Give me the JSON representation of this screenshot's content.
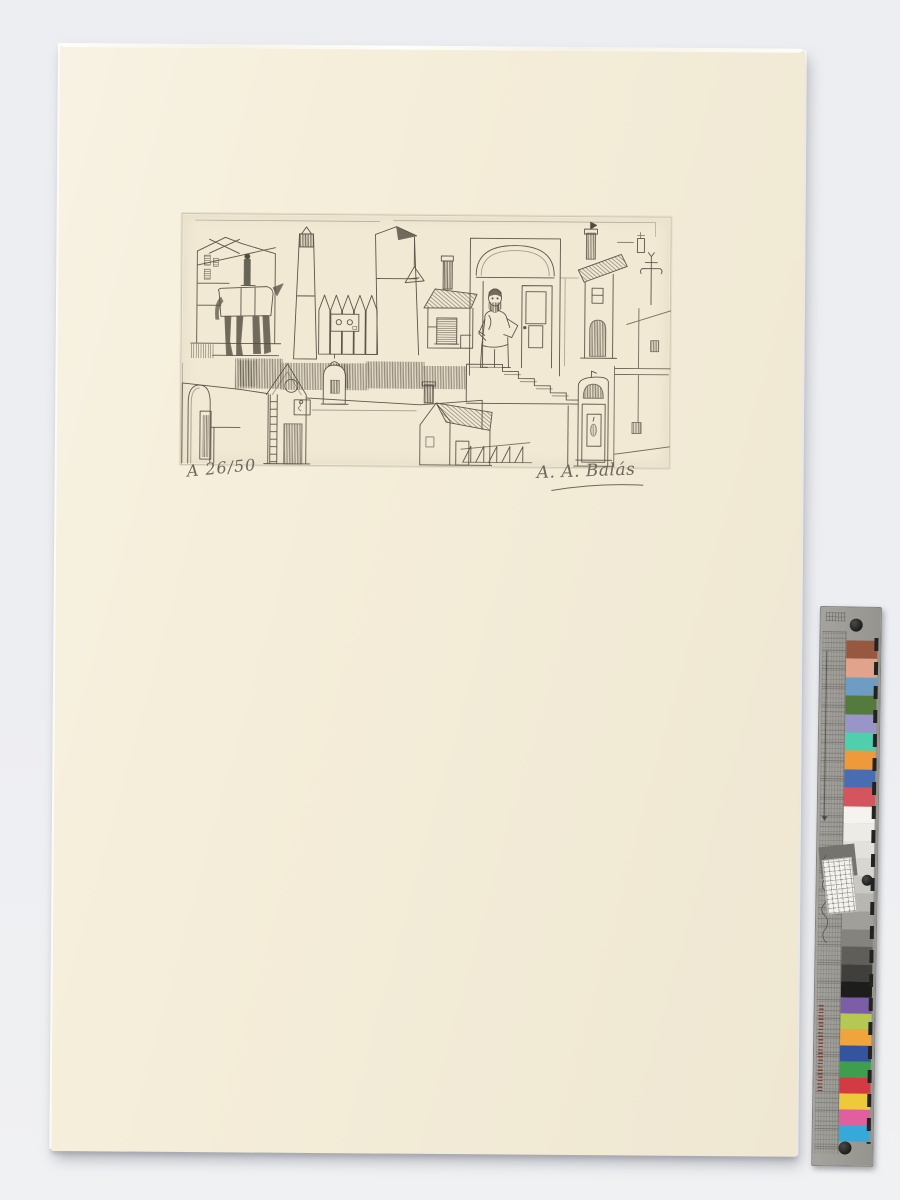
{
  "scene": {
    "background_color": "#edeef1",
    "paper_color": "#f5eeda",
    "plate_tone": "#f1e9d4",
    "ink_color": "#4e4639",
    "pencil_color": "#6e675c"
  },
  "artwork": {
    "inscription": "A 26/50",
    "signature": "A. A. Balás"
  },
  "colorbar": {
    "card_color": "#a5a39e",
    "patches_top": [
      "#96583f",
      "#e2a38c",
      "#6f9cc3",
      "#547a3d",
      "#9995c8",
      "#4fcfae",
      "#ee9a3b",
      "#4a6cb3",
      "#d5555f"
    ],
    "grayscale": [
      "#f4f3ef",
      "#ecebe6",
      "#e2e1dc",
      "#d7d6d1",
      "#c9c8c3",
      "#b7b6b1",
      "#a09f9a",
      "#84837e",
      "#5f5e59",
      "#403f3b"
    ],
    "patches_bottom": [
      "#1d1d1b",
      "#7b5ea7",
      "#b5c853",
      "#efa43c",
      "#34549f",
      "#3f9e4e",
      "#d33a44",
      "#efc93c",
      "#e0609f",
      "#36a9d9"
    ]
  }
}
